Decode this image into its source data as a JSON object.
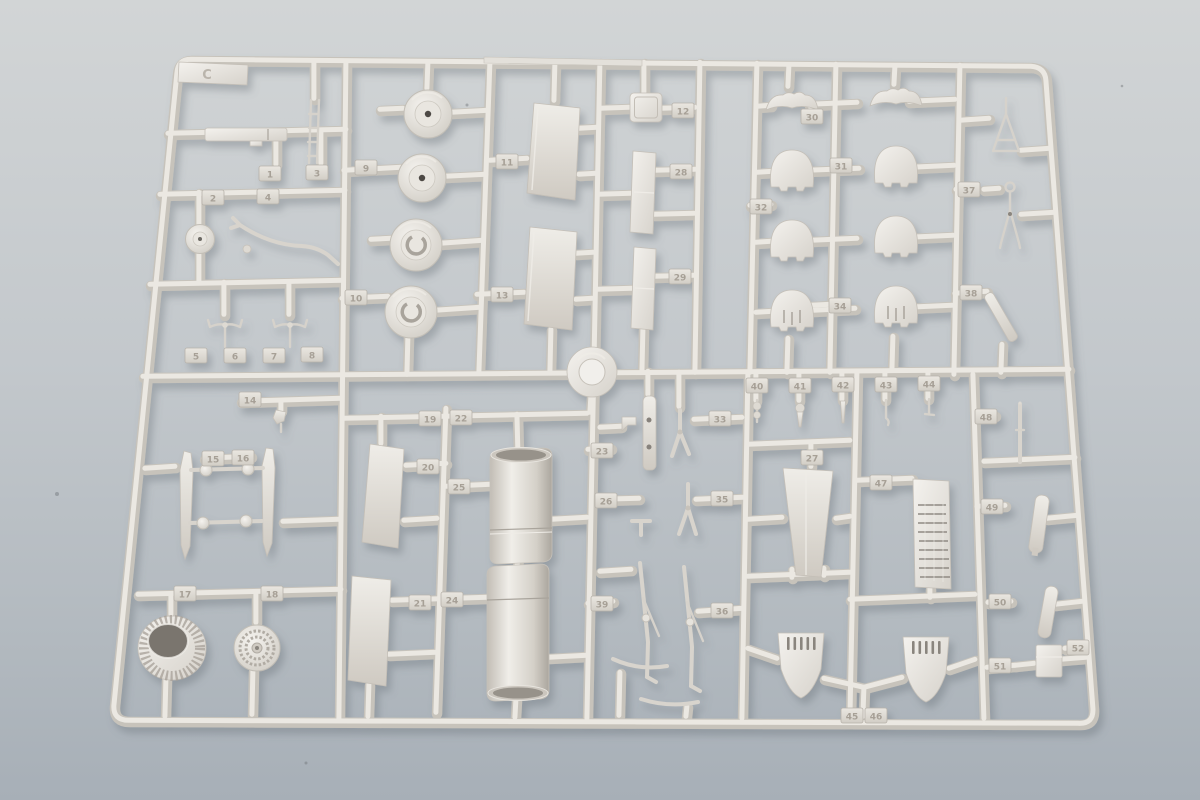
{
  "scene": {
    "description": "Photograph of a light-grey injection-moulded plastic model kit sprue lying on a blue-grey surface",
    "background_top_color": "#d2d5d6",
    "background_bottom_color": "#a7afb7",
    "plastic_base_color": "#d9d5cf",
    "plastic_highlight_color": "#f0eee9",
    "plastic_shadow_color": "#b0aba3"
  },
  "sprue": {
    "gate_label": "C",
    "tabs": {
      "t1": "1",
      "t2": "2",
      "t3": "3",
      "t4": "4",
      "t5": "5",
      "t6": "6",
      "t7": "7",
      "t8": "8",
      "t9": "9",
      "t10": "10",
      "t11": "11",
      "t12": "12",
      "t13": "13",
      "t14": "14",
      "t15": "15",
      "t16": "16",
      "t17": "17",
      "t18": "18",
      "t19": "19",
      "t20": "20",
      "t21": "21",
      "t22": "22",
      "t23": "23",
      "t24": "24",
      "t25": "25",
      "t26": "26",
      "t27": "27",
      "t28": "28",
      "t29": "29",
      "t30": "30",
      "t31": "31",
      "t32": "32",
      "t33": "33",
      "t34": "34",
      "t35": "35",
      "t36": "36",
      "t37": "37",
      "t38": "38",
      "t39": "39",
      "t40": "40",
      "t41": "41",
      "t42": "42",
      "t43": "43",
      "t44": "44",
      "t45": "45",
      "t46": "46",
      "t47": "47",
      "t48": "48",
      "t49": "49",
      "t50": "50",
      "t51": "51",
      "t52": "52"
    },
    "parts_inventory": [
      "four main-wheel halves",
      "tail wheel and wheel hub",
      "fuselage spar bar",
      "boarding ladder",
      "bent tail-wheel strut",
      "two wire aerials",
      "two gear-door blades with ball links",
      "finned engine cowling ring",
      "ribbed supercharger disc",
      "four flap / control-surface panels",
      "three canopy / hatch plates",
      "eight engine cowl sections",
      "antenna A-frame mast and gear fork",
      "two drop-tank cylinder halves",
      "spinner back-plate",
      "two landing-gear legs",
      "tapered ventral blade panel",
      "louvred radiator core",
      "two slotted tail cones",
      "assorted pins, paddles and rods"
    ]
  }
}
